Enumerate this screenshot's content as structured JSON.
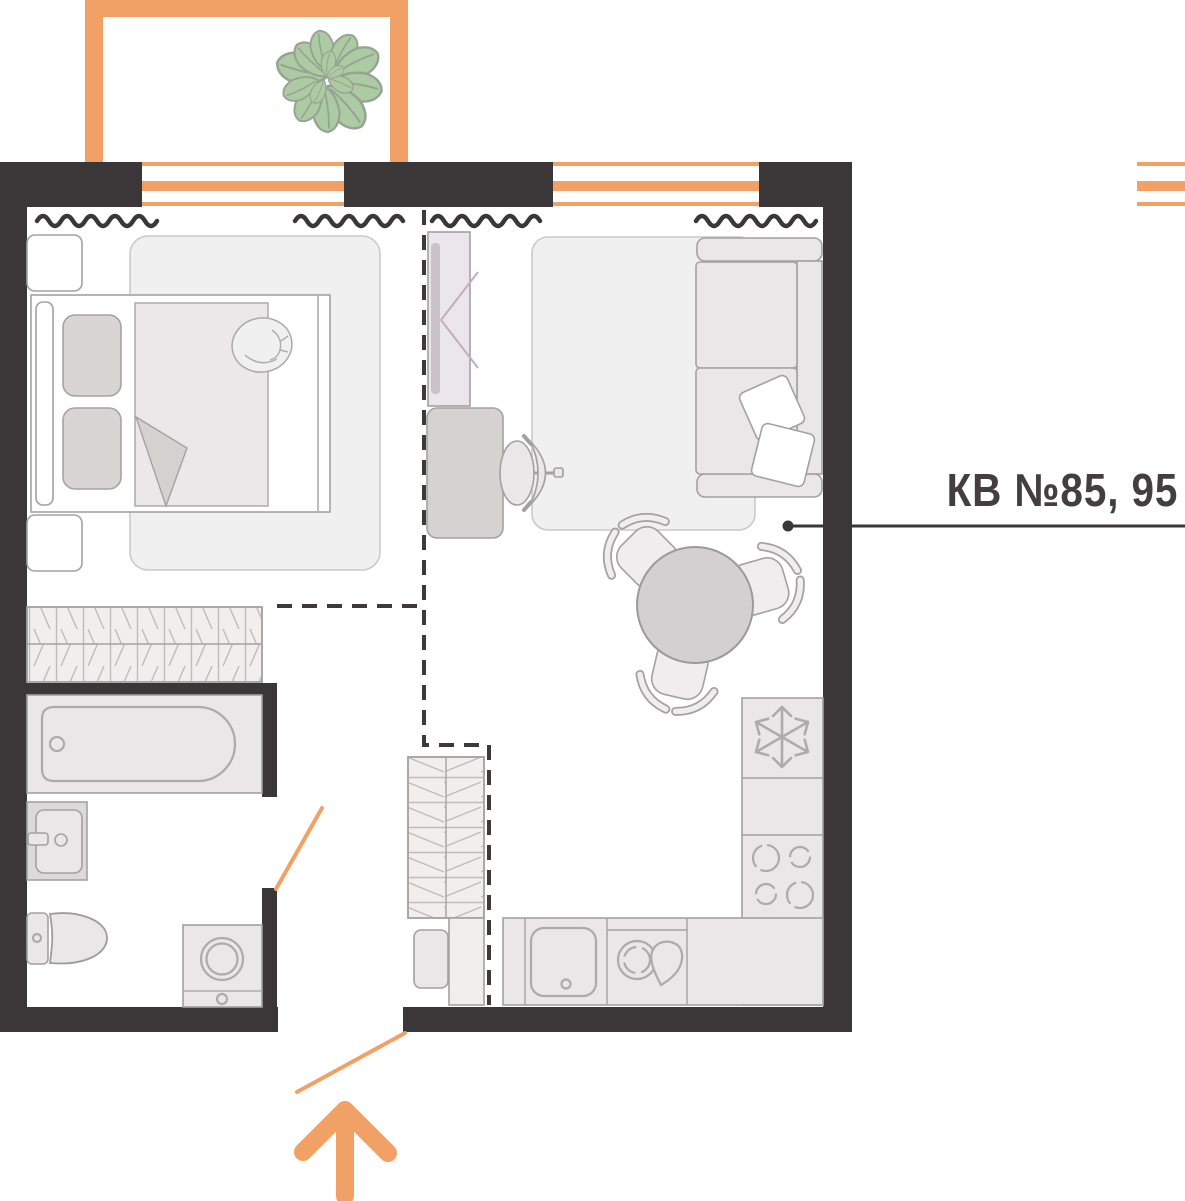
{
  "label": {
    "apartment_number": "КВ №85, 95"
  },
  "colors": {
    "wall": "#3B3637",
    "accent": "#F2A166",
    "furniture_stroke": "#A3A1A1",
    "appliance_stroke": "#ACAAAA",
    "furniture_fill": "#E9E7E7",
    "furniture_fill_dark": "#D5D2D2",
    "rug_fill": "#F1F0F0",
    "hatch_fill": "#F1EFEE",
    "plant_fill": "#ACCBA3",
    "plant_stroke": "#97A392",
    "label_text": "#453E40"
  },
  "icons": {
    "fridge": "snowflake-icon",
    "stove": "four-burners-icon",
    "kitchen_sink": "basin-with-drain-icon",
    "dishwasher": "plate-and-drop-icon",
    "washing_machine": "drum-circle-icon",
    "entrance_direction": "arrow-up-icon",
    "balcony_plant": "plant-icon",
    "windows_decor": "wavy-line-icon",
    "wardrobes": "hatched-storage-icon"
  }
}
